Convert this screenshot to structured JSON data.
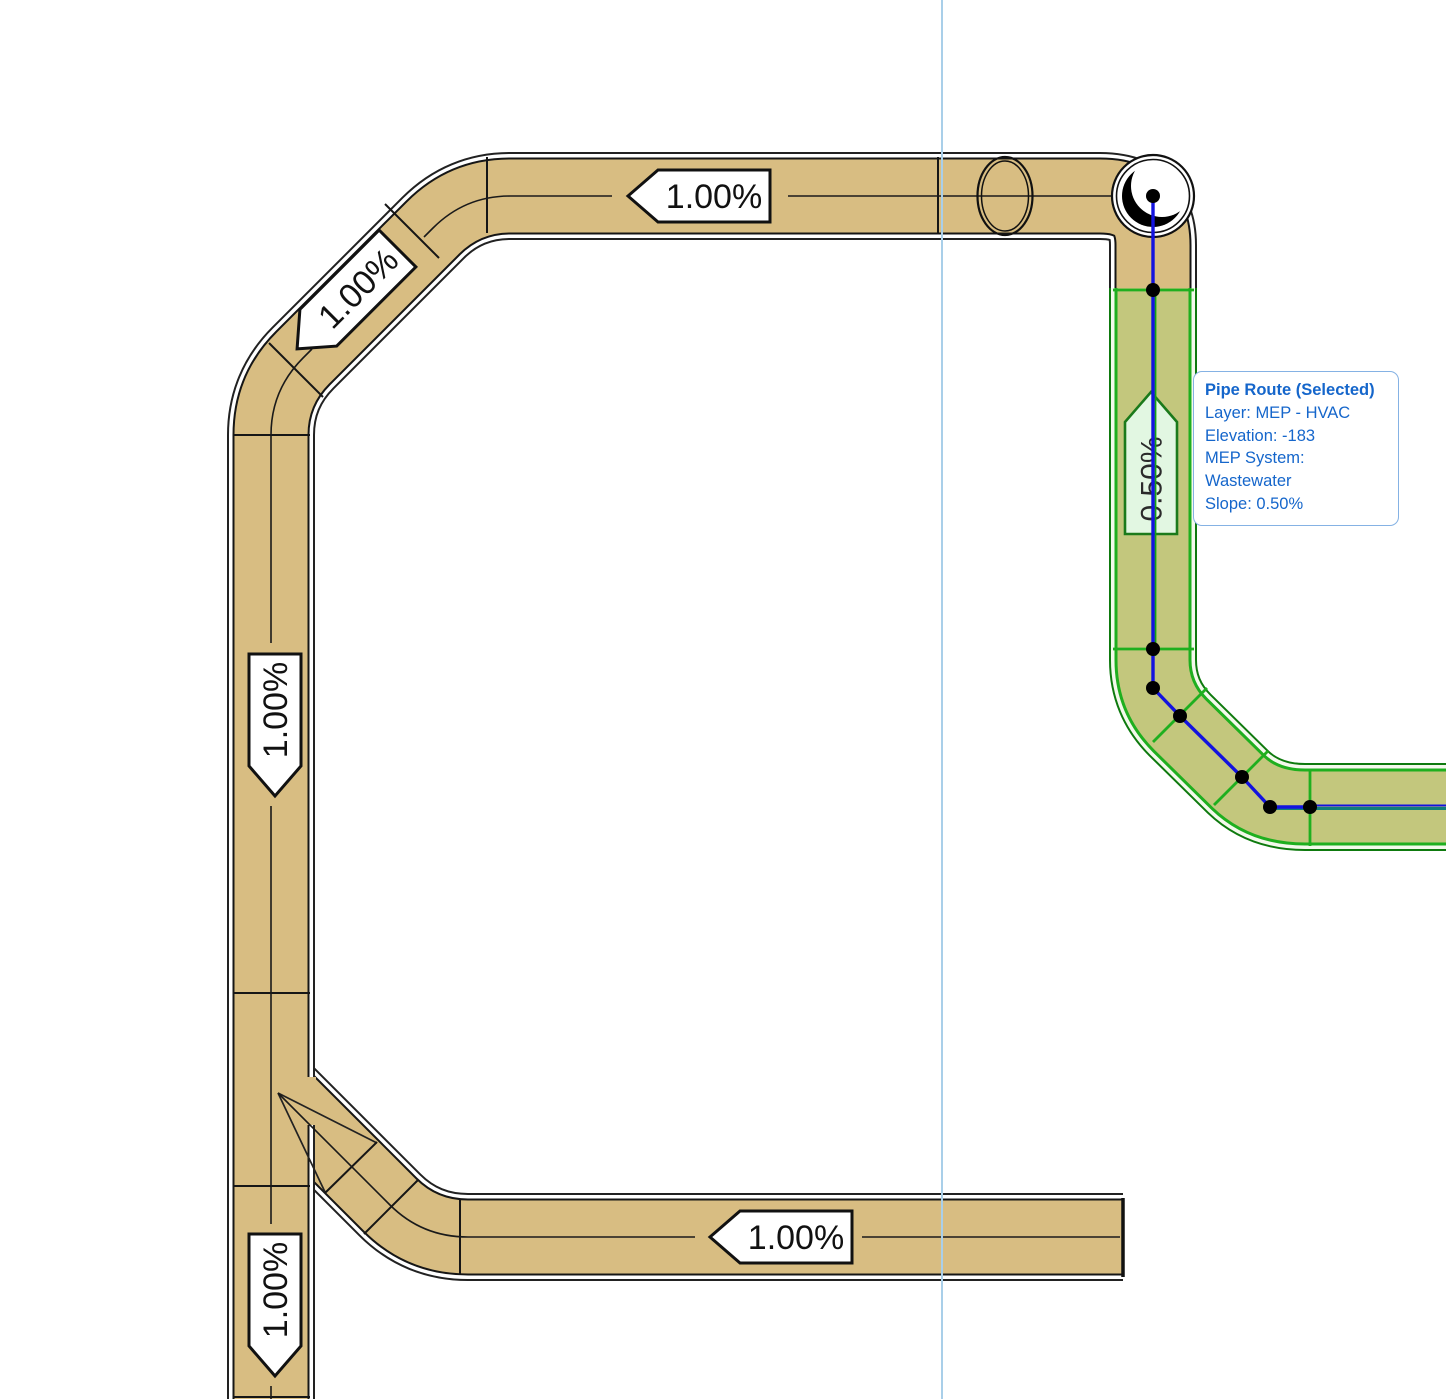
{
  "app": {
    "name": "MEP pipe plan view"
  },
  "colors": {
    "pipe_fill": "#D8BD82",
    "pipe_edge": "#1a1a1a",
    "selected_fill": "#C3C77D",
    "selected_edge": "#1FAF1F",
    "route_line": "#1313DF",
    "route_exit_line": "#0E7E78",
    "guide_line": "#A9CFE9",
    "tooltip_text": "#1566CB",
    "tooltip_border": "#85B2E4"
  },
  "slope_labels": [
    {
      "id": "top-horizontal",
      "value": "1.00%",
      "direction": "left"
    },
    {
      "id": "upper-left-diagonal",
      "value": "1.00%",
      "direction": "down-left"
    },
    {
      "id": "left-vertical",
      "value": "1.00%",
      "direction": "down"
    },
    {
      "id": "selected-vertical",
      "value": "0.50%",
      "direction": "up"
    },
    {
      "id": "bottom-horizontal",
      "value": "1.00%",
      "direction": "left"
    },
    {
      "id": "bottom-left-vertical",
      "value": "1.00%",
      "direction": "down"
    }
  ],
  "tooltip": {
    "title": "Pipe Route (Selected)",
    "lines": [
      "Layer: MEP - HVAC",
      "Elevation: -183",
      "MEP System: Wastewater",
      "Slope: 0.50%"
    ]
  }
}
